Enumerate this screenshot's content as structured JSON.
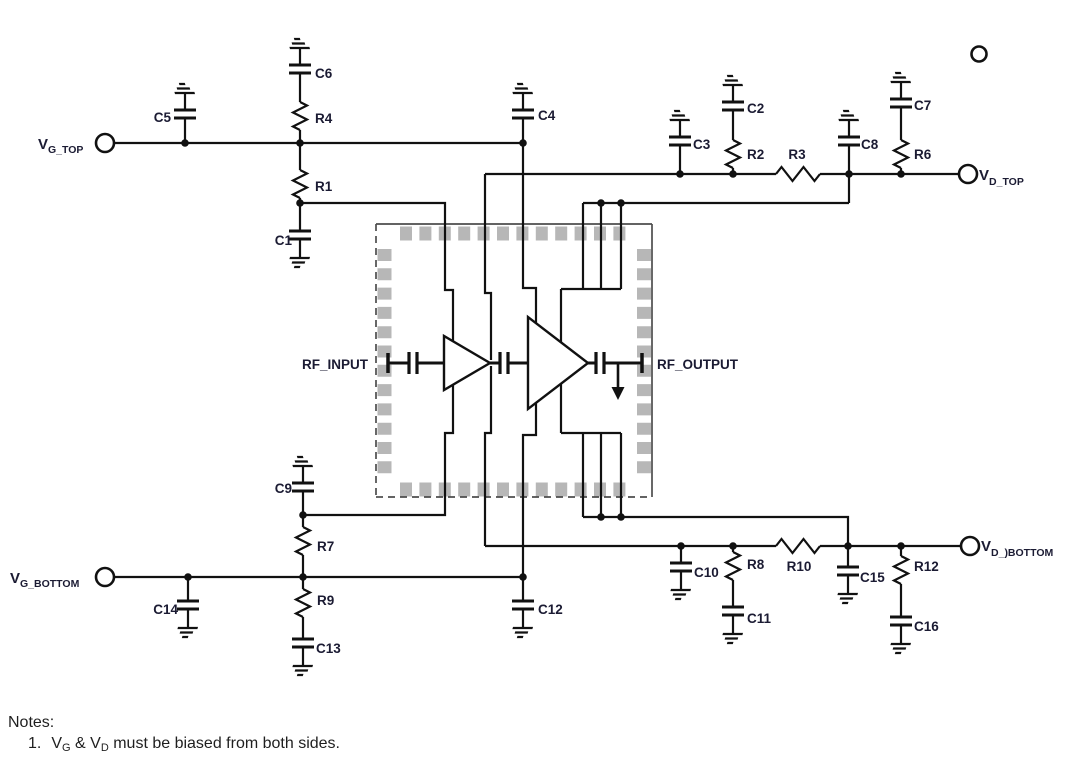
{
  "labels": {
    "c1": "C1",
    "c2": "C2",
    "c3": "C3",
    "c4": "C4",
    "c5": "C5",
    "c6": "C6",
    "c7": "C7",
    "c8": "C8",
    "c9": "C9",
    "c10": "C10",
    "c11": "C11",
    "c12": "C12",
    "c13": "C13",
    "c14": "C14",
    "c15": "C15",
    "c16": "C16",
    "r1": "R1",
    "r2": "R2",
    "r3": "R3",
    "r4": "R4",
    "r6": "R6",
    "r7": "R7",
    "r8": "R8",
    "r9": "R9",
    "r10": "R10",
    "r12": "R12",
    "rf_input": "RF_INPUT",
    "rf_output": "RF_OUTPUT"
  },
  "terminals": {
    "vg_top": {
      "main": "V",
      "sub": "G_TOP"
    },
    "vd_top": {
      "main": "V",
      "sub": "D_TOP"
    },
    "vg_bottom": {
      "main": "V",
      "sub": "G_BOTTOM"
    },
    "vd_bottom": {
      "main": "V",
      "sub": "D_)BOTTOM"
    }
  },
  "notes": {
    "heading": "Notes:",
    "item1": {
      "num": "1.",
      "v1": "V",
      "sub1": "G",
      "mid": " & V",
      "sub2": "D",
      "rest": " must be biased from both sides."
    }
  },
  "colors": {
    "wire": "#111111",
    "label": "#1b1b33",
    "pad": "#b7b7b7",
    "package_outline": "#4d4d4d",
    "background": "#ffffff"
  }
}
